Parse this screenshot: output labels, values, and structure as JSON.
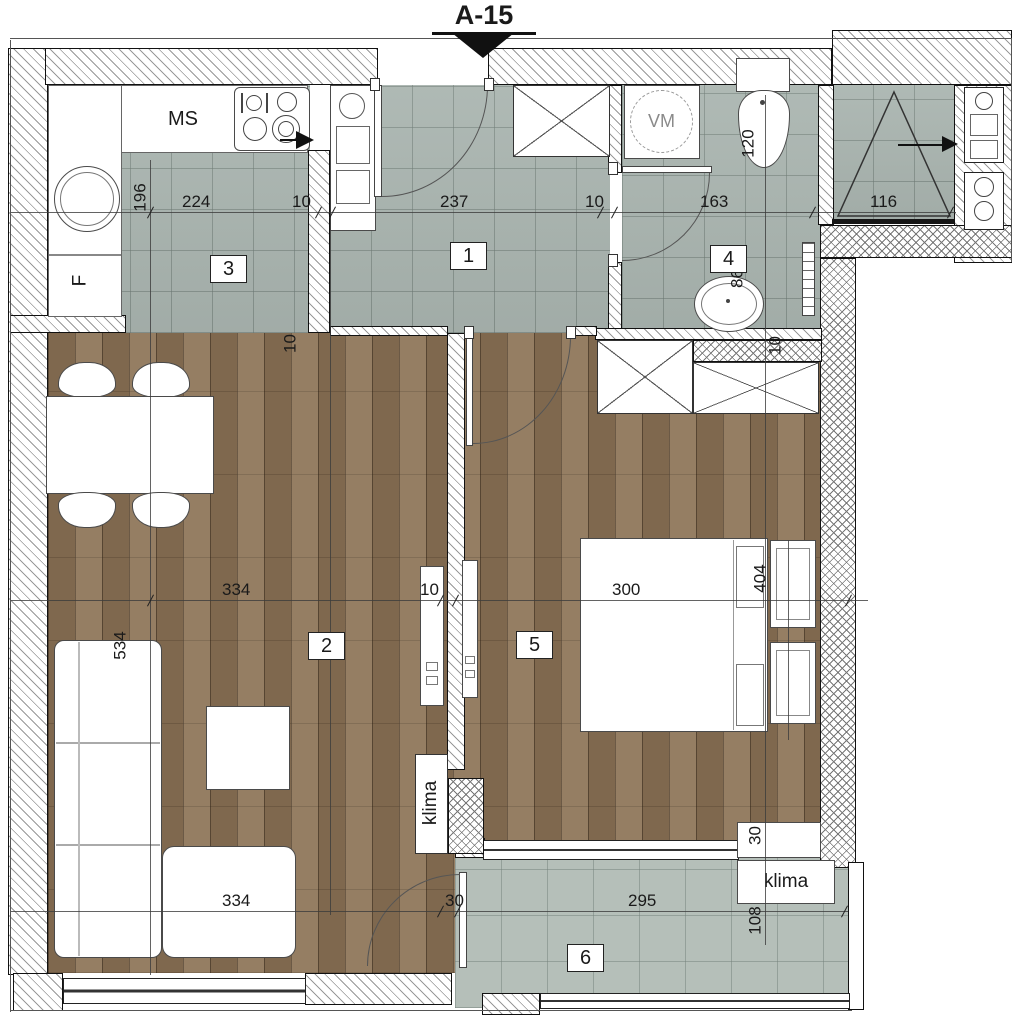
{
  "title": "A-15",
  "rooms": {
    "hall": "1",
    "living": "2",
    "kitchen": "3",
    "bath": "4",
    "bedroom": "5",
    "terrace": "6"
  },
  "labels": {
    "kitchen_unit": "MS",
    "fridge": "F",
    "washing_machine": "VM",
    "ac_living": "klima",
    "ac_terrace": "klima"
  },
  "dims": {
    "kitchen_depth": "196",
    "kitchen_width": "224",
    "wall_kh": "10",
    "hall_width": "237",
    "wall_hb": "10",
    "bath_width": "163",
    "shower_width": "116",
    "toilet_depth": "120",
    "bath_depth": "86",
    "bath_wall": "10",
    "floor_gap": "10",
    "living_width": "334",
    "wall_lb": "10",
    "bedroom_width": "300",
    "bedroom_depth": "404",
    "living_depth": "534",
    "sofa_width": "334",
    "terrace_door": "30",
    "terrace_width": "295",
    "ac_niche": "30",
    "terrace_depth": "108"
  }
}
